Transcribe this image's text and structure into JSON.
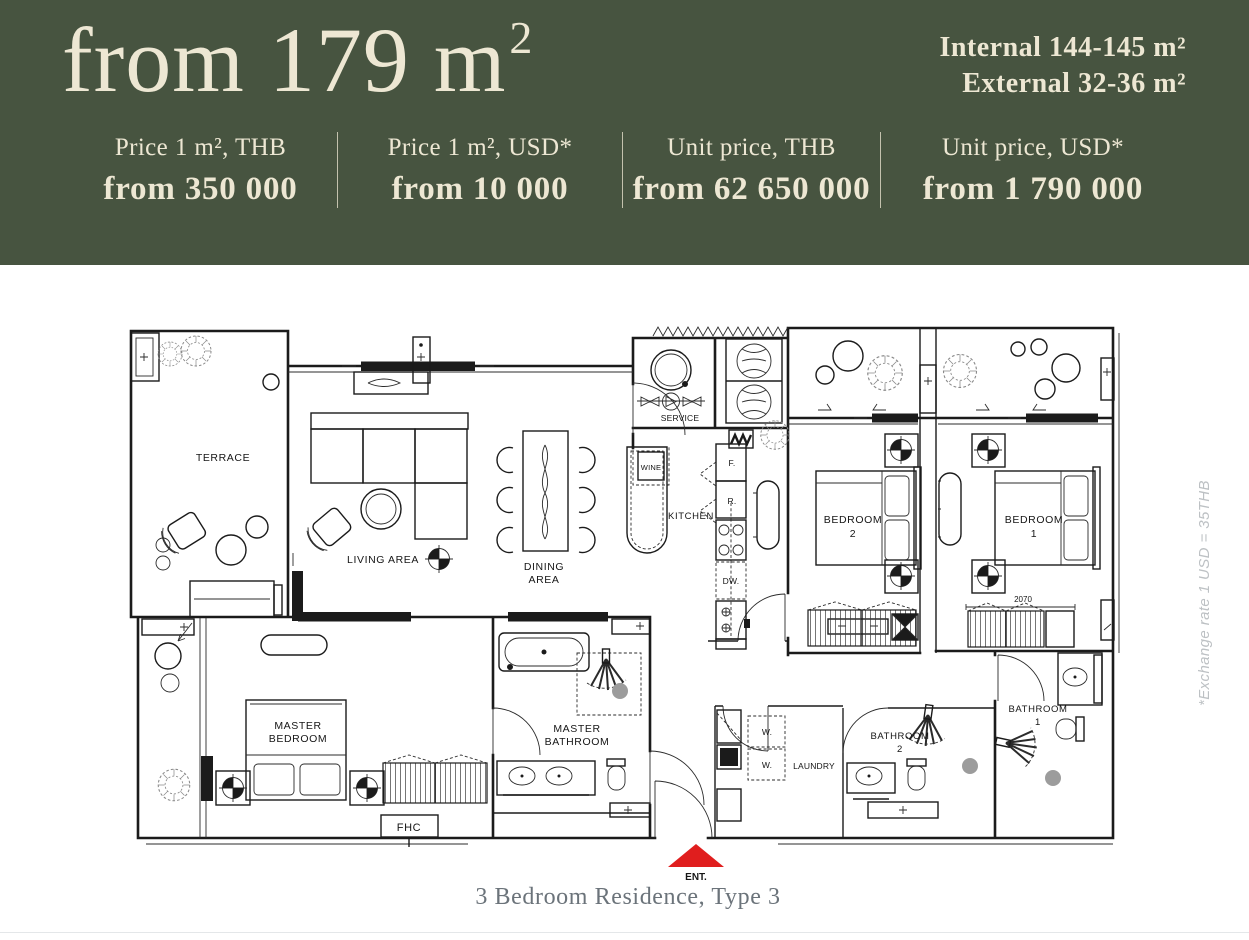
{
  "colors": {
    "header_bg": "#475440",
    "header_text": "#EDE7D3",
    "caption": "#6B737A",
    "footnote": "#BDC1C4",
    "accent_red": "#E01E1E",
    "plan_line": "#1B1B1B"
  },
  "header": {
    "title": "from 179 m",
    "title_sup": "2",
    "stats": [
      {
        "label": "Price 1 m², THB",
        "value": "from 350 000"
      },
      {
        "label": "Price 1 m², USD*",
        "value": "from 10 000"
      },
      {
        "label": "Unit price, THB",
        "value": "from 62 650 000"
      },
      {
        "label": "Unit price, USD*",
        "value": "from 1 790 000"
      }
    ],
    "areas": [
      {
        "text": "Internal 144-145 m²"
      },
      {
        "text": "External 32-36 m²"
      }
    ]
  },
  "plan": {
    "rooms": {
      "terrace": "TERRACE",
      "living": "LIVING  AREA",
      "dining_l1": "DINING",
      "dining_l2": "AREA",
      "service": "SERVICE",
      "kitchen": "KITCHEN",
      "wine": "WINE",
      "bedroom2_l1": "BEDROOM",
      "bedroom2_l2": "2",
      "bedroom1_l1": "BEDROOM",
      "bedroom1_l2": "1",
      "master_bedroom_l1": "MASTER",
      "master_bedroom_l2": "BEDROOM",
      "master_bathroom_l1": "MASTER",
      "master_bathroom_l2": "BATHROOM",
      "laundry": "LAUNDRY",
      "bathroom2_l1": "BATHROOM",
      "bathroom2_l2": "2",
      "bathroom1_l1": "BATHROOM",
      "bathroom1_l2": "1"
    },
    "appliances": {
      "fridge": "F.",
      "freezer": "R.",
      "dishwasher": "DW.",
      "washer_top": "W.",
      "washer_bottom": "W."
    },
    "annotations": {
      "fhc": "FHC",
      "entrance": "ENT.",
      "dimension": "2070"
    }
  },
  "footnote": "*Exchange rate 1 USD = 35THB",
  "caption": "3 Bedroom Residence, Type 3"
}
